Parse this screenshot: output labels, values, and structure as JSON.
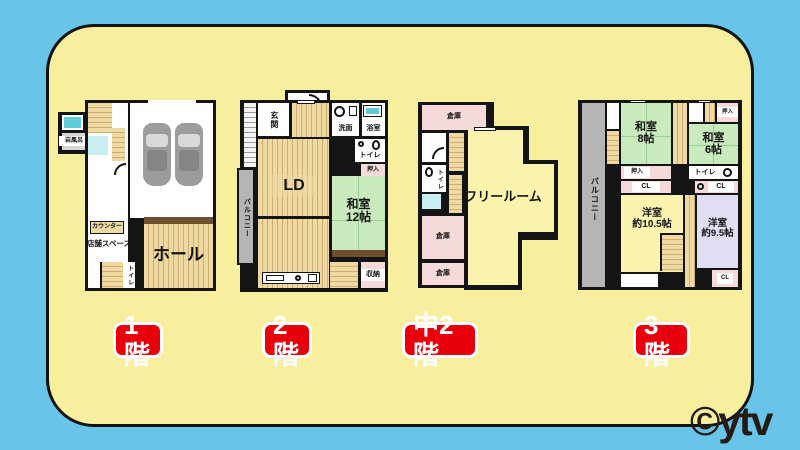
{
  "background_color": "#69c4e9",
  "board_color": "#f8ef9e",
  "accent_red": "#e8000d",
  "watermark": "©ytv",
  "floors": [
    {
      "label": "1階",
      "rooms": {
        "hall": "ホール",
        "shop_space": "店舗スペース",
        "counter": "カウンター",
        "rock_bath": "岩風呂",
        "toilet": "トイレ"
      }
    },
    {
      "label": "2階",
      "rooms": {
        "entrance": "玄関",
        "living_dining": "LD",
        "washroom": "洗面",
        "bathroom": "浴室",
        "toilet": "トイレ",
        "closet": "押入",
        "japanese_room_12": "和室\n12帖",
        "storage": "収納",
        "balcony": "バルコニー"
      }
    },
    {
      "label": "中2階",
      "rooms": {
        "storage_top": "倉庫",
        "storage_mid": "倉庫",
        "storage_bottom": "倉庫",
        "toilet": "トイレ",
        "free_room": "フリールーム"
      }
    },
    {
      "label": "3階",
      "rooms": {
        "japanese_room_8": "和室\n8帖",
        "japanese_room_6": "和室\n6帖",
        "closet_top": "押入",
        "closet_mid": "押入",
        "toilet": "トイレ",
        "cl_left": "CL",
        "cl_right": "CL",
        "cl_bottom": "CL",
        "western_room_105": "洋室\n約10.5帖",
        "western_room_95": "洋室\n約9.5帖",
        "balcony": "バルコニー"
      }
    }
  ]
}
